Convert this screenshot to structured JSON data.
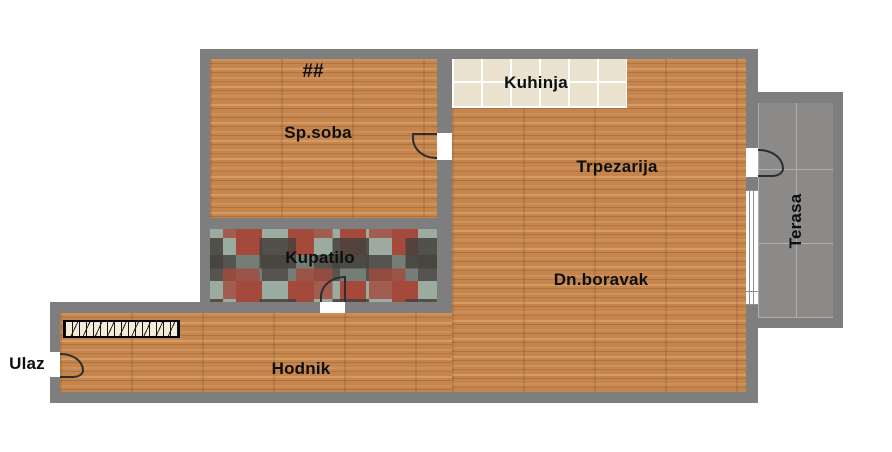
{
  "plan": {
    "rooms": {
      "sp_soba": "Sp.soba",
      "kuhinja": "Kuhinja",
      "trpezarija": "Trpezarija",
      "kupatilo": "Kupatilo",
      "dn_boravak": "Dn.boravak",
      "hodnik": "Hodnik",
      "terasa": "Terasa"
    },
    "entrance_label": "Ulaz",
    "radiator_symbol": "##",
    "colors": {
      "wall": "#7e7e7e",
      "wood_floor": "#c5854d",
      "kitchen_tile": "#eae2cf",
      "bathroom_tile_accent": "#a5493b",
      "terrace_tile": "#8c8989",
      "label_text": "#0e0e0e",
      "background": "#ffffff"
    }
  }
}
